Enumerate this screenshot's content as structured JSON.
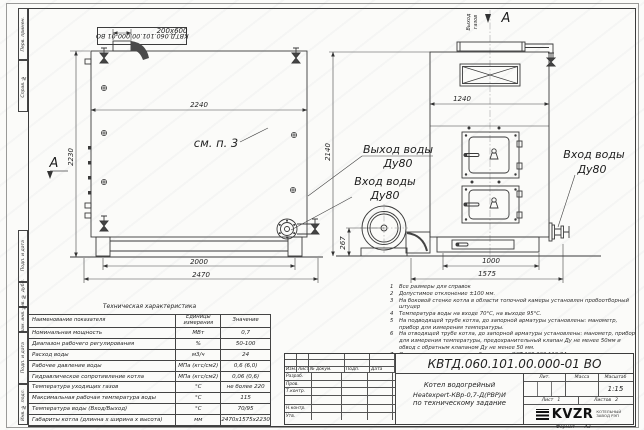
{
  "stamp": {
    "text": "КВТД.060.101.00.000-01 ВО"
  },
  "margin": {
    "items": [
      "Перв. примен.",
      "Справ. №",
      "Подп. и дата",
      "Инв. № дубл.",
      "Взам. инв. №",
      "Подп. и дата",
      "Инв. № подл."
    ]
  },
  "drawing": {
    "section_letter": "А",
    "gas_out_1": "Выход",
    "gas_out_2": "газов",
    "see_note": "см. п. 3",
    "water_out": "Выход воды",
    "water_in": "Вход воды",
    "dn": "Ду80",
    "dims": {
      "nozzle": "200х600",
      "width_top": "2240",
      "height_side": "2230",
      "height_front": "2140",
      "width_front": "1240",
      "base_h": "267",
      "feet": "2000",
      "total_len": "2470",
      "base_front": "1000",
      "total_front": "1575"
    }
  },
  "notes": {
    "items": [
      {
        "n": "1",
        "t": "Все размеры для справок"
      },
      {
        "n": "2",
        "t": "Допустимое отклонение ±100 мм."
      },
      {
        "n": "3",
        "t": "На боковой стенке котла в области топочной камеры установлен пробоотборный штуцер"
      },
      {
        "n": "4",
        "t": "Температура воды на входе 70°С, на выходе 95°С."
      },
      {
        "n": "5",
        "t": "На подводящей трубе котла, до запорной арматуры установлены: манометр, прибор для измерения температуры."
      },
      {
        "n": "6",
        "t": "На отводящей трубе котла, до запорной арматуры установлены: манометр, прибор для измерения температуры, предохранительный клапан Ду не менее 50мм и обвод с обратным клапаном Ду не менее 50 мм."
      },
      {
        "n": "7",
        "t": "Остальные технические требования по ОСТ 108.030.113-84"
      }
    ]
  },
  "spec": {
    "title": "Техническая характеристика",
    "headers": [
      "Наименование показателя",
      "Единицы измерения",
      "Значение"
    ],
    "rows": [
      [
        "Номинальная мощность",
        "МВт",
        "0,7"
      ],
      [
        "Диапазон рабочего регулирования",
        "%",
        "50-100"
      ],
      [
        "Расход воды",
        "м3/ч",
        "24"
      ],
      [
        "Рабочее давление воды",
        "МПа (кгс/см2)",
        "0,6 (6,0)"
      ],
      [
        "Гидравлическое сопротивление котла",
        "МПа (кгс/см2)",
        "0,06 (0,6)"
      ],
      [
        "Температура уходящих газов",
        "°С",
        "не более 220"
      ],
      [
        "Максимальная рабочая температура воды",
        "°С",
        "115"
      ],
      [
        "Температура воды (Вход/Выход)",
        "°С",
        "70/95"
      ],
      [
        "Габариты котла (длинна х ширина х высота)",
        "мм",
        "2470х1575х2230"
      ]
    ]
  },
  "tb": {
    "doc_number": "КВТД.060.101.00.000-01 ВО",
    "title_l1": "Котел водогрейный",
    "title_l2": "Heatexpert-КВр-0,7-Д(РВР)И",
    "title_l3": "по техническому задание",
    "h_izm": "Изм.",
    "h_list": "Лист",
    "h_doc": "№ докум.",
    "h_sign": "Подп.",
    "h_date": "Дата",
    "r1": "Разраб.",
    "r2": "Пров.",
    "r3": "Т.контр.",
    "r4": "Н.контр.",
    "r5": "Утв.",
    "lit": "Лит.",
    "mass": "Масса",
    "scale": "Масштаб",
    "scale_v": "1:15",
    "sheet": "Лист",
    "sheet_v": "1",
    "sheets": "Листов",
    "sheets_v": "2",
    "logo": "KVZR",
    "logo_c1": "КОТЕЛЬНЫЙ",
    "logo_c2": "ЗАВОД РЭП",
    "format_label": "Формат",
    "format_v": "А3"
  }
}
